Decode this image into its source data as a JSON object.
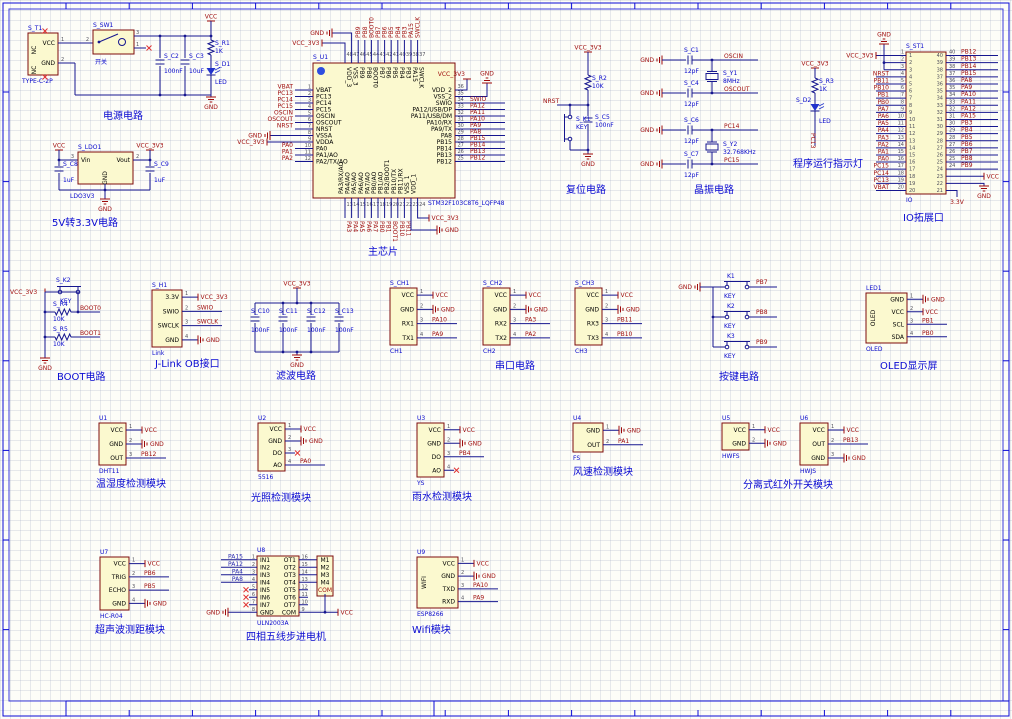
{
  "canvas": {
    "width": 1012,
    "height": 719
  },
  "colors": {
    "wire": "#16168F",
    "component_fill": "#FBF9CF",
    "component_border": "#7D0B0B",
    "net_label": "#9E0A0A",
    "designator": "#0707CC",
    "title": "#0A0AD2",
    "frame": "#0B0BD6"
  },
  "titles": [
    {
      "id": "power",
      "text": "电源电路",
      "x": 103,
      "y": 119
    },
    {
      "id": "ldo",
      "text": "5V转3.3V电路",
      "x": 52,
      "y": 226
    },
    {
      "id": "chip",
      "text": "主芯片",
      "x": 368,
      "y": 255
    },
    {
      "id": "reset",
      "text": "复位电路",
      "x": 566,
      "y": 193
    },
    {
      "id": "xtal",
      "text": "晶振电路",
      "x": 694,
      "y": 193
    },
    {
      "id": "runled",
      "text": "程序运行指示灯",
      "x": 793,
      "y": 167
    },
    {
      "id": "header",
      "text": "IO拓展口",
      "x": 903,
      "y": 221
    },
    {
      "id": "boot",
      "text": "BOOT电路",
      "x": 57,
      "y": 380
    },
    {
      "id": "jlink",
      "text": "J-Link OB接口",
      "x": 155,
      "y": 367
    },
    {
      "id": "filter",
      "text": "滤波电路",
      "x": 276,
      "y": 379
    },
    {
      "id": "serial",
      "text": "串口电路",
      "x": 495,
      "y": 369
    },
    {
      "id": "keys",
      "text": "按键电路",
      "x": 719,
      "y": 380
    },
    {
      "id": "oled",
      "text": "OLED显示屏",
      "x": 880,
      "y": 369
    },
    {
      "id": "dht",
      "text": "温湿度检测模块",
      "x": 96,
      "y": 487
    },
    {
      "id": "light",
      "text": "光照检测模块",
      "x": 251,
      "y": 501
    },
    {
      "id": "rain",
      "text": "雨水检测模块",
      "x": 412,
      "y": 500
    },
    {
      "id": "wind",
      "text": "风速检测模块",
      "x": 573,
      "y": 475
    },
    {
      "id": "ir",
      "text": "分离式红外开关模块",
      "x": 743,
      "y": 488
    },
    {
      "id": "ultra",
      "text": "超声波测距模块",
      "x": 95,
      "y": 633
    },
    {
      "id": "stepper",
      "text": "四相五线步进电机",
      "x": 246,
      "y": 640
    },
    {
      "id": "wifi",
      "text": "Wifi模块",
      "x": 412,
      "y": 633
    }
  ],
  "power": {
    "connector": {
      "ref": "S_T1",
      "part": "TYPE-C-2P",
      "pin_vcc": "VCC",
      "pin_gnd": "GND",
      "num_vcc": "1",
      "num_gnd": "2",
      "nc": "NC"
    },
    "switch": {
      "ref": "S_SW1",
      "label": "开关",
      "num_left": "2",
      "num_top": "3",
      "num_bot": "1"
    },
    "caps": [
      {
        "ref": "S_C2",
        "value": "100nF"
      },
      {
        "ref": "S_C3",
        "value": "10uF"
      }
    ],
    "resistor": {
      "ref": "S_R1",
      "value": "1K"
    },
    "led": {
      "ref": "S_D1",
      "label": "LED"
    },
    "net_vcc": "VCC",
    "net_gnd": "GND"
  },
  "ldo": {
    "ref": "S_LDO1",
    "part": "LDO3V3",
    "pin_vin": "Vin",
    "pin_vout": "Vout",
    "pin_gnd": "GND",
    "num_vin": "3",
    "num_vout": "2",
    "caps": [
      {
        "ref": "S_C8",
        "value": "1uF"
      },
      {
        "ref": "S_C9",
        "value": "1uF"
      }
    ],
    "net_in": "VCC",
    "net_out": "VCC_3V3",
    "net_gnd": "GND"
  },
  "chip": {
    "ref": "S_U1",
    "part": "STM32F103C8T6_LQFP48",
    "left": {
      "nums": [
        "1",
        "2",
        "3",
        "4",
        "5",
        "6",
        "7",
        "8",
        "9",
        "10",
        "11",
        "12"
      ],
      "names": [
        "VBAT",
        "PC13",
        "PC14",
        "PC15",
        "OSCIN",
        "OSCOUT",
        "NRST",
        "VSSA",
        "VDDA",
        "PA0",
        "PA1/AO",
        "PA2/TX/AO"
      ],
      "nets": [
        "VBAT",
        "PC13",
        "PC14",
        "PC15",
        "OSCIN",
        "OSCOUT",
        "NRST",
        "GND",
        "VCC_3V3",
        "PA0",
        "PA1",
        "PA2"
      ]
    },
    "right": {
      "nums": [
        "36",
        "35",
        "34",
        "33",
        "32",
        "31",
        "30",
        "29",
        "28",
        "27",
        "26",
        "25"
      ],
      "names": [
        "VDD_2",
        "VSS_2",
        "SWIO",
        "PA12/USB/DP",
        "PA11/USB/DM",
        "PA10/RX",
        "PA9/TX",
        "PA8",
        "PB15",
        "PB14",
        "PB13",
        "PB12"
      ],
      "nets": [
        "VCC_3V3",
        "GND",
        "SWIO",
        "PA12",
        "PA11",
        "PA10",
        "PA9",
        "PA8",
        "PB15",
        "PB14",
        "PB13",
        "PB12"
      ]
    },
    "top": {
      "nums": [
        "48",
        "47",
        "46",
        "45",
        "44",
        "43",
        "42",
        "41",
        "40",
        "39",
        "38",
        "37"
      ],
      "names": [
        "VDD_3",
        "VSS_3",
        "PB9",
        "PB8",
        "BOOT0",
        "PB7",
        "PB6",
        "PB5",
        "PB4",
        "PB3",
        "PA15",
        "SWCLK"
      ],
      "nets": [
        "VCC_3V3",
        "GND",
        "PB9",
        "PB8",
        "BOOT0",
        "PB7",
        "PB6",
        "PB5",
        "PB4",
        "PB3",
        "PA15",
        "SWCLK"
      ]
    },
    "bottom": {
      "nums": [
        "13",
        "14",
        "15",
        "16",
        "17",
        "18",
        "19",
        "20",
        "21",
        "22",
        "23",
        "24"
      ],
      "names": [
        "PA3/RX/AO",
        "PA4/AO",
        "PA5/AO",
        "PA6/AO",
        "PA7/AO",
        "PB0/AO",
        "PB1/AO",
        "PB2/BOOT1",
        "PB10/TX",
        "PB11/RX",
        "VSS_1",
        "VDD_1"
      ],
      "nets": [
        "PA3",
        "PA4",
        "PA5",
        "PA6",
        "PA7",
        "PB0",
        "PB1",
        "BOOT1",
        "PB10",
        "PB11",
        "GND",
        "VCC_3V3"
      ]
    }
  },
  "reset": {
    "net": "NRST",
    "vcc": "VCC_3V3",
    "gnd": "GND",
    "resistor": {
      "ref": "S_R2",
      "value": "10K"
    },
    "key": {
      "ref": "S_K1",
      "label": "KEY"
    },
    "cap": {
      "ref": "S_C5",
      "value": "100nF"
    }
  },
  "xtal": {
    "gnd": "GND",
    "rows": [
      {
        "ref": "S_C1",
        "value": "12pF",
        "net": "OSCIN"
      },
      {
        "ref": "S_C4",
        "value": "12pF",
        "net": "OSCOUT"
      },
      {
        "ref": "S_C6",
        "value": "12pF",
        "net": "PC14"
      },
      {
        "ref": "S_C7",
        "value": "12pF",
        "net": "PC15"
      }
    ],
    "crystals": [
      {
        "ref": "S_Y1",
        "value": "8MHz"
      },
      {
        "ref": "S_Y2",
        "value": "32.768KHz"
      }
    ]
  },
  "runled": {
    "vcc": "VCC_3V3",
    "resistor": {
      "ref": "S_R3",
      "value": "1K"
    },
    "led": {
      "ref": "S_D2",
      "label": "LED"
    },
    "net": "PC13"
  },
  "header": {
    "ref": "S_ST1",
    "part": "IO",
    "bottom_net": "3.3V",
    "left": {
      "nums": [
        "1",
        "2",
        "3",
        "4",
        "5",
        "6",
        "7",
        "8",
        "9",
        "10",
        "11",
        "12",
        "13",
        "14",
        "15",
        "16",
        "17",
        "18",
        "19",
        "20"
      ],
      "nets": [
        "VCC_3V3",
        "GND",
        "",
        "NRST",
        "PB11",
        "PB10",
        "PB1",
        "PB0",
        "PA7",
        "PA6",
        "PA5",
        "PA4",
        "PA3",
        "PA2",
        "PA1",
        "PA0",
        "PC15",
        "PC14",
        "PC13",
        "VBAT"
      ]
    },
    "right": {
      "nums": [
        "40",
        "39",
        "38",
        "37",
        "36",
        "35",
        "34",
        "33",
        "32",
        "31",
        "30",
        "29",
        "28",
        "27",
        "26",
        "25",
        "24",
        "23",
        "22",
        "21"
      ],
      "nets": [
        "PB12",
        "PB13",
        "PB14",
        "PB15",
        "PA8",
        "PA9",
        "PA10",
        "PA11",
        "PA12",
        "PA15",
        "PB3",
        "PB4",
        "PB5",
        "PB6",
        "PB7",
        "PB8",
        "PB9",
        "VCC",
        "GND",
        "3.3V"
      ]
    }
  },
  "boot": {
    "vcc": "VCC_3V3",
    "gnd": "GND",
    "key": {
      "ref": "S_K2",
      "label": "KEY"
    },
    "resistors": [
      {
        "ref": "S_R4",
        "value": "10K",
        "net": "BOOT0"
      },
      {
        "ref": "S_R5",
        "value": "10K",
        "net": "BOOT1"
      }
    ]
  },
  "filter": {
    "vcc": "VCC_3V3",
    "gnd": "GND",
    "caps": [
      {
        "ref": "S_C10",
        "value": "100nF"
      },
      {
        "ref": "S_C11",
        "value": "100nF"
      },
      {
        "ref": "S_C12",
        "value": "100nF"
      },
      {
        "ref": "S_C13",
        "value": "100nF"
      }
    ]
  },
  "keys": {
    "gnd": "GND",
    "items": [
      {
        "ref": "K1",
        "label": "KEY",
        "net": "PB7"
      },
      {
        "ref": "K2",
        "label": "KEY",
        "net": "PB8"
      },
      {
        "ref": "K3",
        "label": "KEY",
        "net": "PB9"
      }
    ]
  },
  "modules": [
    {
      "id": "jlink",
      "ref": "S_H1",
      "part": "Link",
      "x": 152,
      "y": 290,
      "w": 30,
      "h": 57,
      "rows": [
        {
          "name": "3.3V",
          "num": "1",
          "net": {
            "t": "vcc",
            "label": "VCC_3V3"
          }
        },
        {
          "name": "SWIO",
          "num": "2",
          "net": {
            "t": "net",
            "label": "SWIO"
          }
        },
        {
          "name": "SWCLK",
          "num": "3",
          "net": {
            "t": "net",
            "label": "SWCLK"
          }
        },
        {
          "name": "GND",
          "num": "4",
          "net": {
            "t": "gnd",
            "label": "GND"
          }
        }
      ]
    },
    {
      "id": "ch1",
      "ref": "S_CH1",
      "part": "CH1",
      "x": 390,
      "y": 288,
      "w": 27,
      "h": 57,
      "rows": [
        {
          "name": "VCC",
          "num": "1",
          "net": {
            "t": "vcc",
            "label": "VCC"
          }
        },
        {
          "name": "GND",
          "num": "2",
          "net": {
            "t": "gnd",
            "label": "GND"
          }
        },
        {
          "name": "RX1",
          "num": "3",
          "net": {
            "t": "net",
            "label": "PA10"
          }
        },
        {
          "name": "TX1",
          "num": "4",
          "net": {
            "t": "net",
            "label": "PA9"
          }
        }
      ]
    },
    {
      "id": "ch2",
      "ref": "S_CH2",
      "part": "CH2",
      "x": 483,
      "y": 288,
      "w": 27,
      "h": 57,
      "rows": [
        {
          "name": "VCC",
          "num": "1",
          "net": {
            "t": "vcc",
            "label": "VCC"
          }
        },
        {
          "name": "GND",
          "num": "2",
          "net": {
            "t": "gnd",
            "label": "GND"
          }
        },
        {
          "name": "RX2",
          "num": "3",
          "net": {
            "t": "net",
            "label": "PA3"
          }
        },
        {
          "name": "TX2",
          "num": "4",
          "net": {
            "t": "net",
            "label": "PA2"
          }
        }
      ]
    },
    {
      "id": "ch3",
      "ref": "S_CH3",
      "part": "CH3",
      "x": 575,
      "y": 288,
      "w": 27,
      "h": 57,
      "rows": [
        {
          "name": "VCC",
          "num": "1",
          "net": {
            "t": "vcc",
            "label": "VCC"
          }
        },
        {
          "name": "GND",
          "num": "2",
          "net": {
            "t": "gnd",
            "label": "GND"
          }
        },
        {
          "name": "RX3",
          "num": "3",
          "net": {
            "t": "net",
            "label": "PB11"
          }
        },
        {
          "name": "TX3",
          "num": "4",
          "net": {
            "t": "net",
            "label": "PB10"
          }
        }
      ]
    },
    {
      "id": "oled",
      "ref": "LED1",
      "part": "OLED",
      "vtext": "OLED",
      "x": 866,
      "y": 293,
      "w": 41,
      "h": 50,
      "rows": [
        {
          "name": "GND",
          "num": "1",
          "net": {
            "t": "gnd",
            "label": "GND"
          }
        },
        {
          "name": "VCC",
          "num": "2",
          "net": {
            "t": "vcc",
            "label": "VCC"
          }
        },
        {
          "name": "SCL",
          "num": "3",
          "net": {
            "t": "net",
            "label": "PB1"
          }
        },
        {
          "name": "SDA",
          "num": "4",
          "net": {
            "t": "net",
            "label": "PB0"
          }
        }
      ]
    },
    {
      "id": "dht11",
      "ref": "U1",
      "part": "DHT11",
      "x": 99,
      "y": 423,
      "w": 27,
      "h": 42,
      "rows": [
        {
          "name": "VCC",
          "num": "1",
          "net": {
            "t": "vcc",
            "label": "VCC"
          }
        },
        {
          "name": "GND",
          "num": "2",
          "net": {
            "t": "gnd",
            "label": "GND"
          }
        },
        {
          "name": "OUT",
          "num": "3",
          "net": {
            "t": "net",
            "label": "PB12"
          }
        }
      ]
    },
    {
      "id": "light",
      "ref": "U2",
      "part": "5516",
      "x": 258,
      "y": 423,
      "w": 27,
      "h": 48,
      "rows": [
        {
          "name": "VCC",
          "num": "1",
          "net": {
            "t": "vcc",
            "label": "VCC"
          }
        },
        {
          "name": "GND",
          "num": "2",
          "net": {
            "t": "gnd",
            "label": "GND"
          }
        },
        {
          "name": "DO",
          "num": "3",
          "net": {
            "t": "nc"
          }
        },
        {
          "name": "AO",
          "num": "4",
          "net": {
            "t": "net",
            "label": "PA0"
          }
        }
      ]
    },
    {
      "id": "rain",
      "ref": "U3",
      "part": "YS",
      "x": 417,
      "y": 423,
      "w": 27,
      "h": 54,
      "rows": [
        {
          "name": "VCC",
          "num": "1",
          "net": {
            "t": "vcc",
            "label": "VCC"
          }
        },
        {
          "name": "GND",
          "num": "2",
          "net": {
            "t": "gnd",
            "label": "GND"
          }
        },
        {
          "name": "DO",
          "num": "3",
          "net": {
            "t": "net",
            "label": "PB4"
          }
        },
        {
          "name": "AO",
          "num": "4",
          "net": {
            "t": "nc"
          }
        }
      ]
    },
    {
      "id": "wind",
      "ref": "U4",
      "part": "FS",
      "x": 573,
      "y": 423,
      "w": 30,
      "h": 29,
      "rows": [
        {
          "name": "GND",
          "num": "1",
          "net": {
            "t": "gnd",
            "label": "GND"
          }
        },
        {
          "name": "OUT",
          "num": "2",
          "net": {
            "t": "net",
            "label": "PA1"
          }
        }
      ]
    },
    {
      "id": "ir1",
      "ref": "U5",
      "part": "HWFS",
      "x": 722,
      "y": 423,
      "w": 27,
      "h": 27,
      "rows": [
        {
          "name": "VCC",
          "num": "1",
          "net": {
            "t": "vcc",
            "label": "VCC"
          }
        },
        {
          "name": "GND",
          "num": "2",
          "net": {
            "t": "gnd",
            "label": "GND"
          }
        }
      ]
    },
    {
      "id": "ir2",
      "ref": "U6",
      "part": "HWJS",
      "x": 800,
      "y": 423,
      "w": 28,
      "h": 42,
      "rows": [
        {
          "name": "VCC",
          "num": "1",
          "net": {
            "t": "vcc",
            "label": "VCC"
          }
        },
        {
          "name": "OUT",
          "num": "2",
          "net": {
            "t": "net",
            "label": "PB13"
          }
        },
        {
          "name": "GND",
          "num": "3",
          "net": {
            "t": "gnd",
            "label": "GND"
          }
        }
      ]
    },
    {
      "id": "ultra",
      "ref": "U7",
      "part": "HC-R04",
      "x": 100,
      "y": 557,
      "w": 29,
      "h": 53,
      "rows": [
        {
          "name": "VCC",
          "num": "1",
          "net": {
            "t": "vcc",
            "label": "VCC"
          }
        },
        {
          "name": "TRIG",
          "num": "2",
          "net": {
            "t": "net",
            "label": "PB6"
          }
        },
        {
          "name": "ECHO",
          "num": "3",
          "net": {
            "t": "net",
            "label": "PB5"
          }
        },
        {
          "name": "GND",
          "num": "4",
          "net": {
            "t": "gnd",
            "label": "GND"
          }
        }
      ]
    },
    {
      "id": "wifi",
      "ref": "U9",
      "part": "ESP8266",
      "vtext": "WIFI",
      "x": 417,
      "y": 557,
      "w": 41,
      "h": 51,
      "rows": [
        {
          "name": "VCC",
          "num": "1",
          "net": {
            "t": "vcc",
            "label": "VCC"
          }
        },
        {
          "name": "GND",
          "num": "2",
          "net": {
            "t": "gnd",
            "label": "GND"
          }
        },
        {
          "name": "TXD",
          "num": "3",
          "net": {
            "t": "net",
            "label": "PA10"
          }
        },
        {
          "name": "RXD",
          "num": "4",
          "net": {
            "t": "net",
            "label": "PA9"
          }
        }
      ]
    }
  ],
  "uln": {
    "ref": "U8",
    "part": "ULN2003A",
    "vcc": "VCC",
    "gnd": "GND",
    "left": {
      "names": [
        "IN1",
        "IN2",
        "IN3",
        "IN4",
        "IN5",
        "IN6",
        "IN7",
        "GND"
      ],
      "nums": [
        "1",
        "2",
        "3",
        "4",
        "5",
        "6",
        "7",
        "8"
      ],
      "nets": [
        "PA15",
        "PA12",
        "PA4",
        "PA8",
        "NC",
        "NC",
        "NC",
        "GND"
      ]
    },
    "right": {
      "names": [
        "OT1",
        "OT2",
        "OT3",
        "OT4",
        "OT5",
        "OT6",
        "OT7",
        "COM"
      ],
      "nums": [
        "16",
        "15",
        "14",
        "13",
        "12",
        "11",
        "10",
        "9"
      ]
    },
    "conn": {
      "pins": [
        "M1",
        "M2",
        "M3",
        "M4"
      ],
      "com": "COM"
    }
  }
}
